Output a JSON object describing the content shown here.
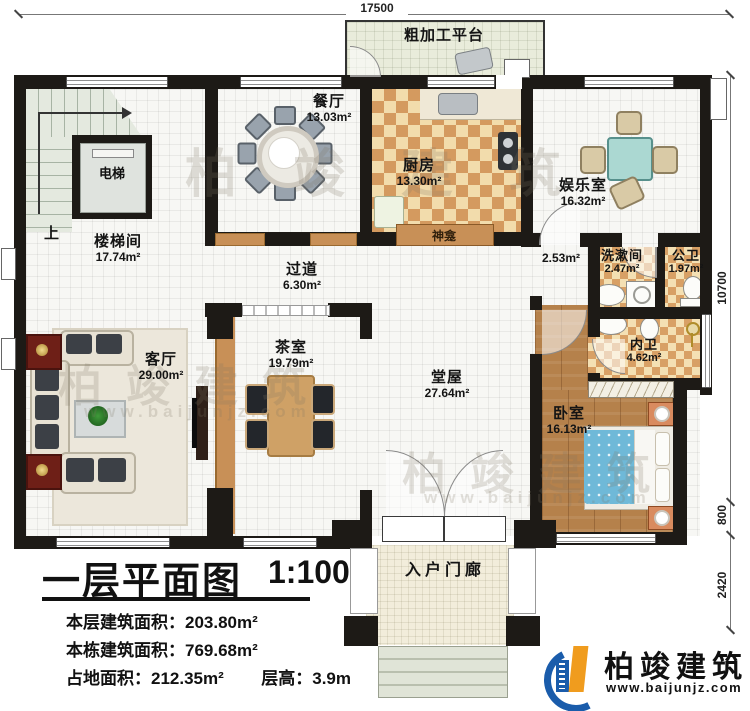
{
  "plan": {
    "title": "一层平面图",
    "scale": "1:100",
    "info": {
      "line1_label": "本层建筑面积：",
      "line1_value": "203.80m²",
      "line2_label": "本栋建筑面积：",
      "line2_value": "769.68m²",
      "line3_label": "占地面积：",
      "line3_value": "212.35m²",
      "line4_label": "层高：",
      "line4_value": "3.9m"
    }
  },
  "rooms": {
    "stairwell": {
      "name": "楼梯间",
      "area": "17.74m²"
    },
    "elevator": {
      "name": "电梯"
    },
    "up": {
      "name": "上"
    },
    "dining": {
      "name": "餐厅",
      "area": "13.03m²"
    },
    "kitchen": {
      "name": "厨房",
      "area": "13.30m²"
    },
    "platform": {
      "name": "粗加工平台"
    },
    "entertainment": {
      "name": "娱乐室",
      "area": "16.32m²"
    },
    "shrine": {
      "name": "神龛"
    },
    "passage": {
      "area": "2.53m²"
    },
    "corridor": {
      "name": "过道",
      "area": "6.30m²"
    },
    "washroom": {
      "name": "洗漱间",
      "area": "2.47m²"
    },
    "public_wc": {
      "name": "公卫",
      "area": "1.97m²"
    },
    "private_wc": {
      "name": "内卫",
      "area": "4.62m²"
    },
    "living": {
      "name": "客厅",
      "area": "29.00m²"
    },
    "tea": {
      "name": "茶室",
      "area": "19.79m²"
    },
    "hall": {
      "name": "堂屋",
      "area": "27.64m²"
    },
    "bedroom": {
      "name": "卧室",
      "area": "16.13m²"
    },
    "porch": {
      "name": "入户门廊"
    }
  },
  "dims": {
    "top": "17500",
    "right_main": "10700",
    "right_mid": "800",
    "right_bottom": "2420"
  },
  "brand": {
    "name": "柏竣建筑",
    "url": "www.baijunjz.com"
  },
  "colors": {
    "wall": "#1d1a16",
    "checker_dark": "#d49a5f",
    "checker_light": "#f2dcac",
    "wood": "#b5814b",
    "bed_blanket": "#6fb9d8",
    "partition": "#c89057",
    "brand_blue": "#1a5cab",
    "brand_orange": "#f09c1e"
  }
}
